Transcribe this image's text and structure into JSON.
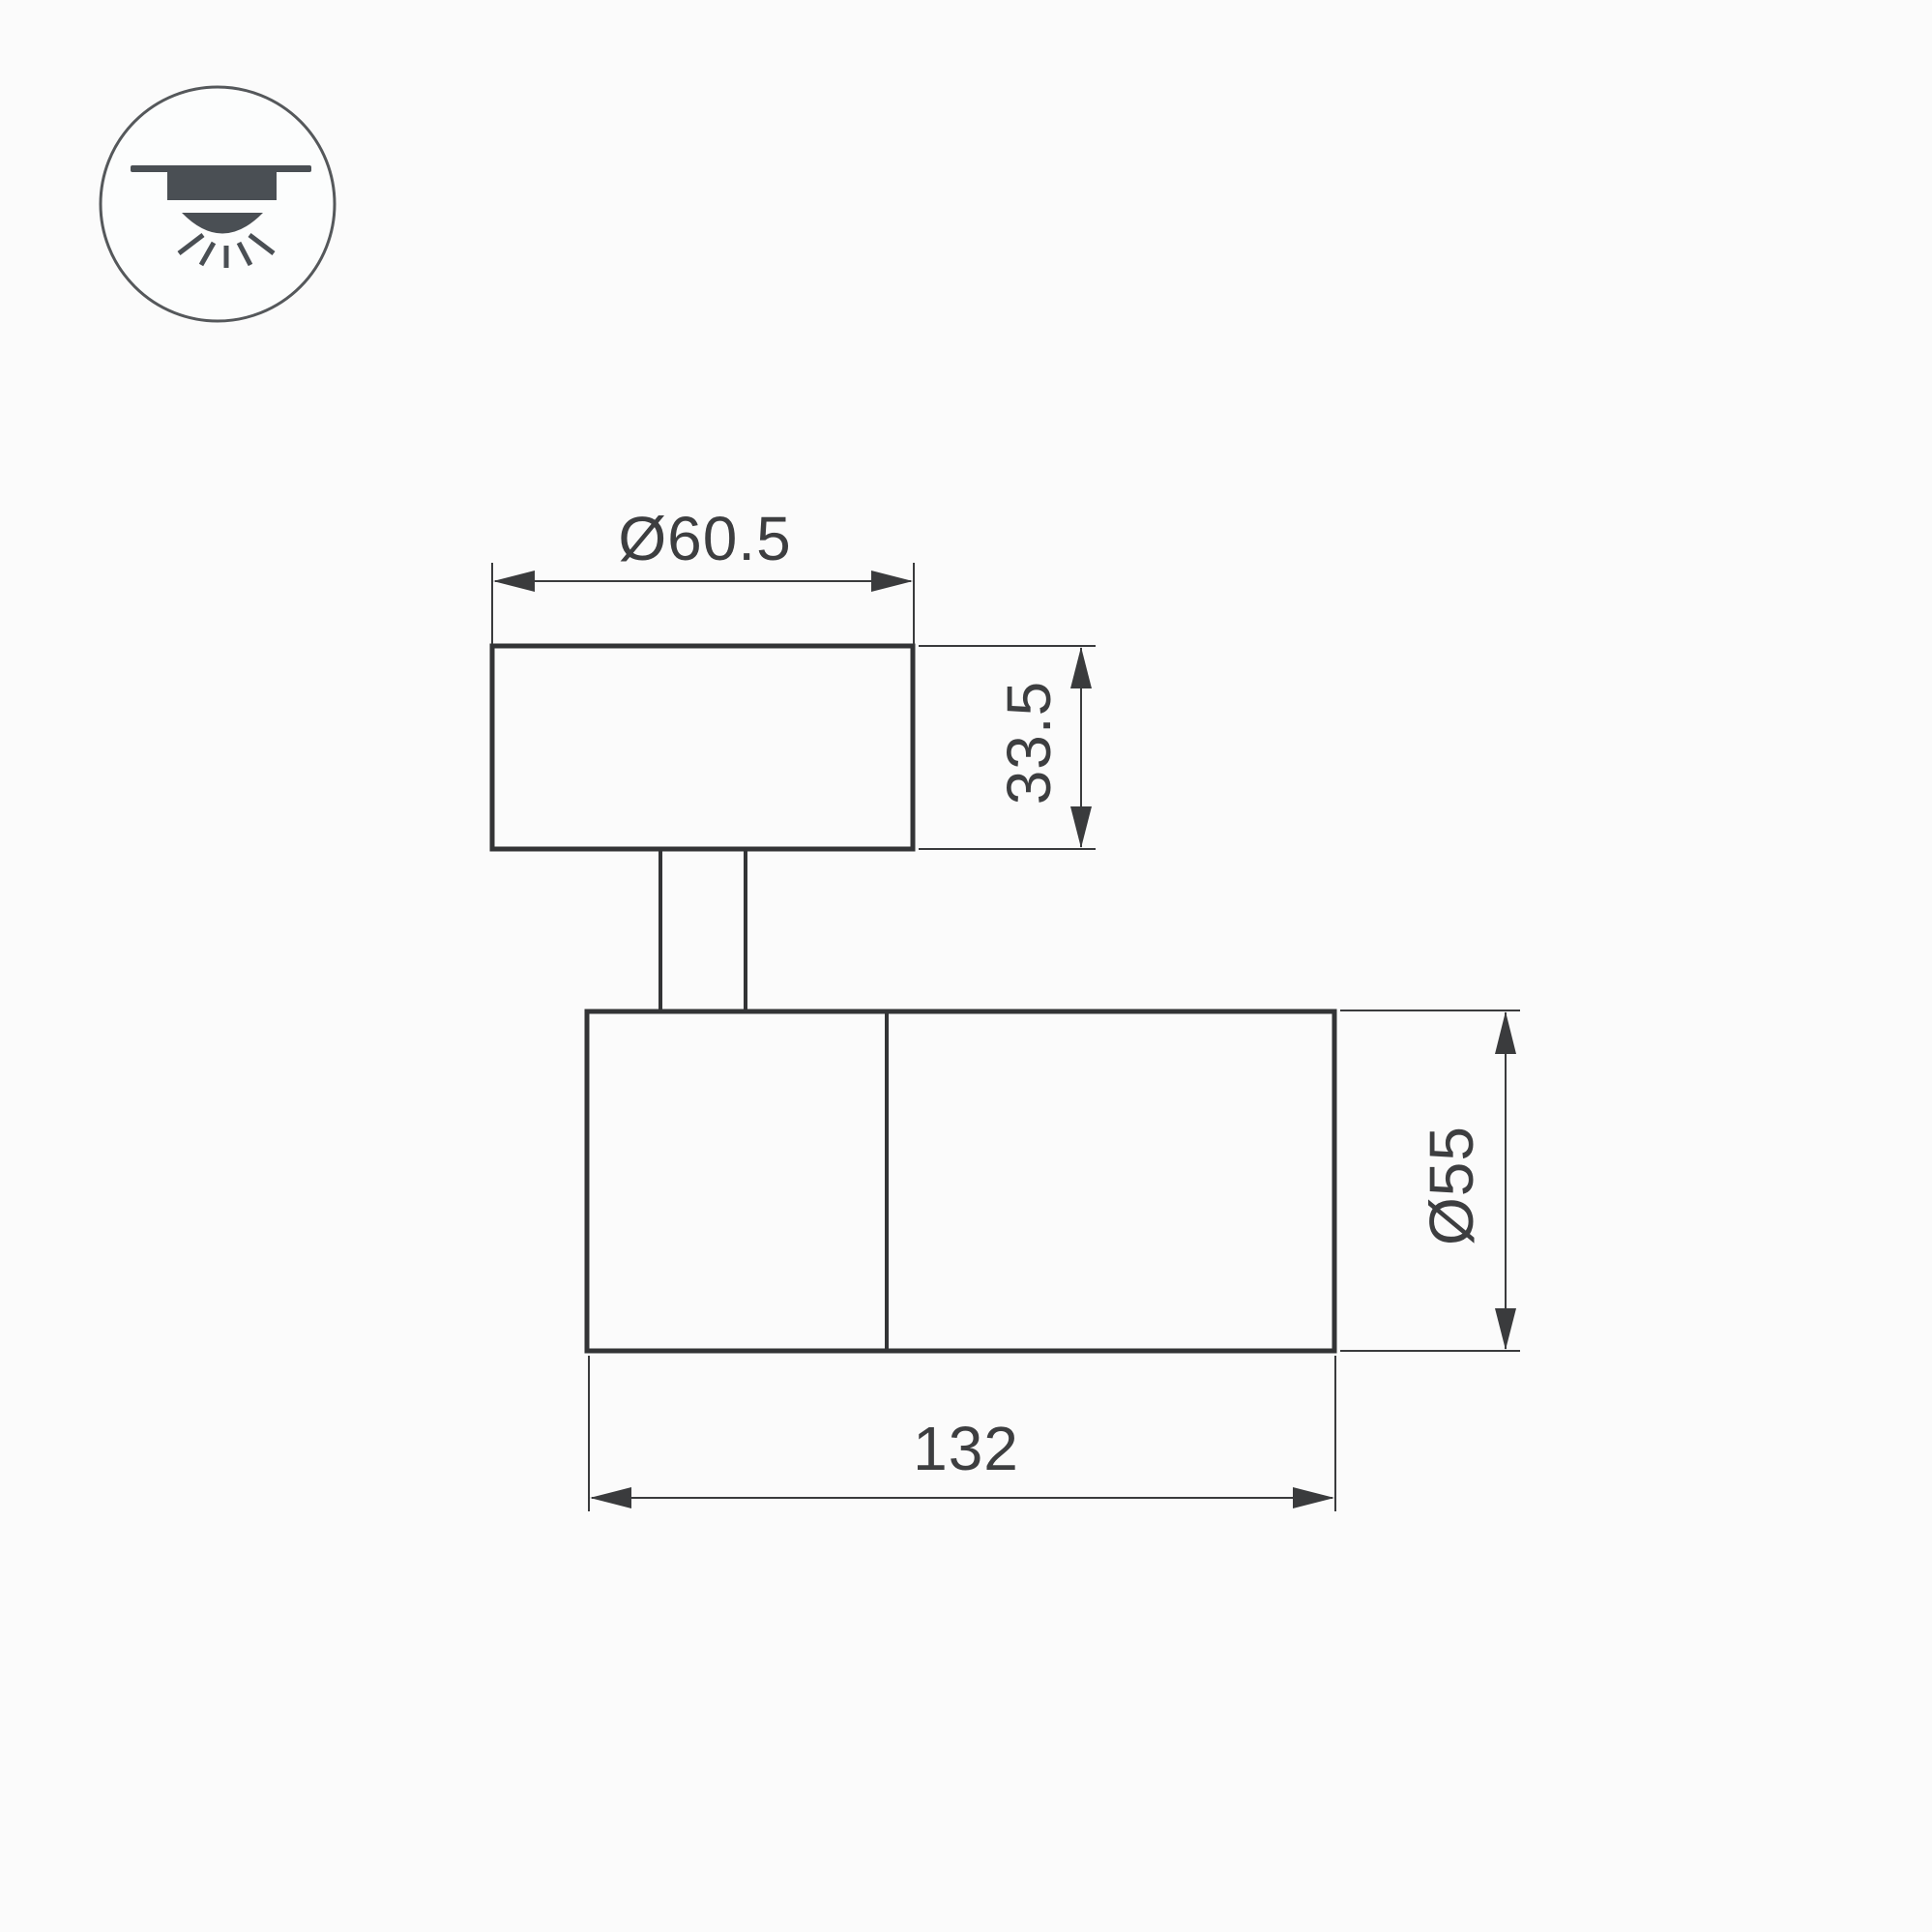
{
  "meta": {
    "type": "technical-dimension-drawing",
    "background": "#fbfbfb",
    "line_color": "#333436",
    "dimension_line_color": "#3a3b3d",
    "text_color": "#3d3e40",
    "icon_color": "#4a4f54"
  },
  "icon": {
    "name": "surface-mounted-downlight-icon",
    "meaning": "ceiling surface mount luminaire"
  },
  "dimensions": {
    "mount_diameter": "Ø60.5",
    "mount_height": "33.5",
    "body_diameter": "Ø55",
    "body_length": "132"
  }
}
